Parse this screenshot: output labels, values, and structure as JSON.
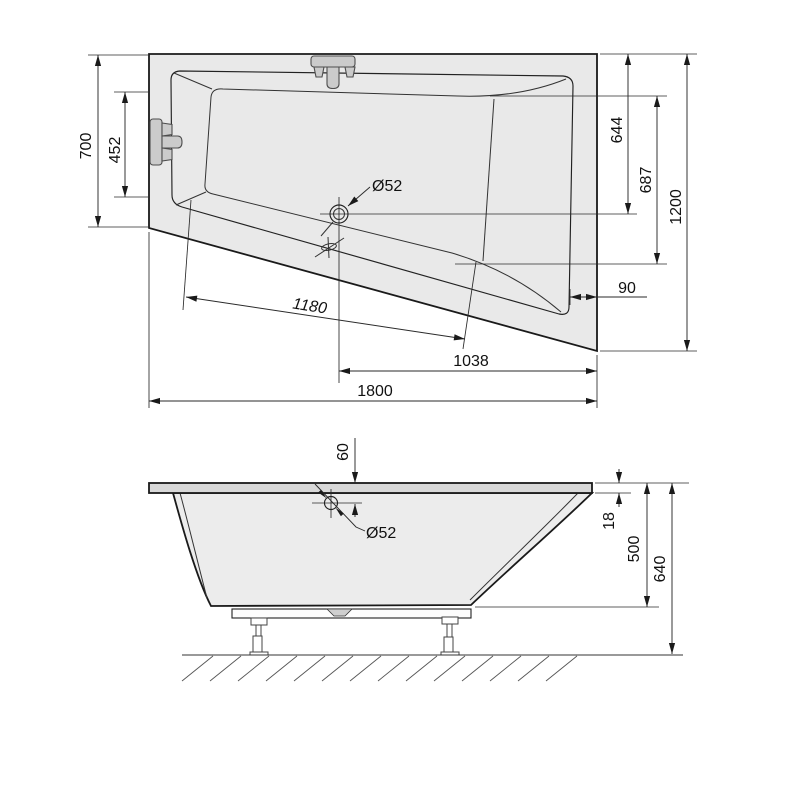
{
  "colors": {
    "line": "#1a1a1a",
    "deck_fill": "#e9e9e9",
    "basin_fill": "#f3f3f3",
    "body_fill": "#ececec",
    "rim_fill": "#d8d8d8",
    "fixture_fill": "#cbcbcb",
    "notch_fill": "#cfcfcf"
  },
  "top_view": {
    "labels": {
      "left_height": "700",
      "inner_left": "452",
      "drain_from_top": "644",
      "inner_right": "687",
      "right_height": "1200",
      "rim_width": "90",
      "inner_diagonal": "1180",
      "drain_from_right": "1038",
      "total_length": "1800",
      "drain_diameter": "Ø52"
    }
  },
  "side_view": {
    "labels": {
      "drain_offset": "60",
      "drain_diameter": "Ø52",
      "rim_thickness": "18",
      "body_depth": "500",
      "total_height": "640"
    }
  }
}
